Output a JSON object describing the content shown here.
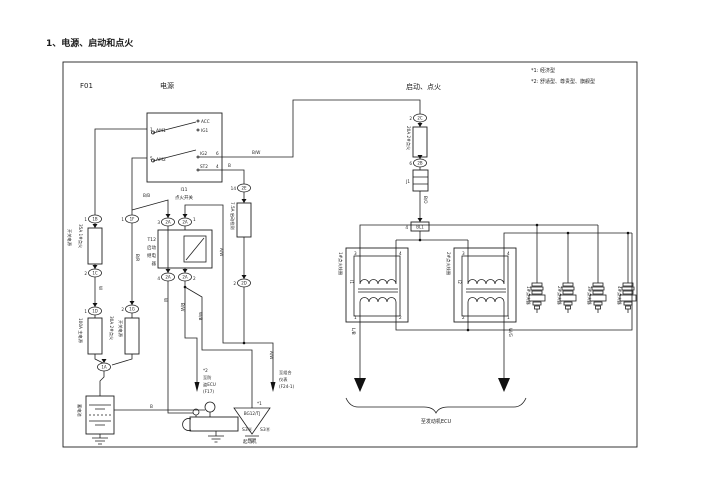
{
  "title": "1、电源、启动和点火",
  "header": {
    "code": "F01",
    "power": "电源",
    "start": "启动、点火",
    "note1": "*1: 经济型",
    "note2": "*2: 舒适型、尊贵型、旗舰型"
  },
  "switch": {
    "id": "I11",
    "name": "点火开关",
    "am1_pin": "1",
    "am1": "AM1",
    "am2_pin": "5",
    "am2": "AM2",
    "acc": "ACC",
    "ig1": "IG1",
    "ig2": "IG2",
    "ig2_pin": "6",
    "st2": "ST2",
    "st2_pin": "4"
  },
  "fuses": {
    "f1a": "开关电源",
    "f1b": "35A 1#点火",
    "f2": "100A 主电源",
    "f3a": "30A 2#点火",
    "f3b": "开关电源",
    "f4": "20A 2#点火",
    "f5": "7.5A 启动检测"
  },
  "relay": {
    "l1": "T12",
    "l2": "启动",
    "l3": "继电",
    "l4": "器",
    "pin_tl": "3",
    "pin_tr": "1",
    "pin_bl": "4",
    "pin_br": "2"
  },
  "battery": {
    "label": "蓄电池"
  },
  "starter": {
    "t1": "S3Ⓐ",
    "t2": "S3Ⓑ",
    "label": "起动机"
  },
  "connectors": {
    "o1_pin": "1",
    "o1": "1B",
    "o2_pin": "2",
    "o2": "1C",
    "o3_pin": "1",
    "o3": "1D",
    "o4": "1A",
    "o5_pin": "1",
    "o5": "1F",
    "o6_pin": "2",
    "o6": "1G",
    "o7": "2A",
    "o8": "2A",
    "o9": "2A",
    "o10": "2A",
    "o11_pin": "14",
    "o11": "2E",
    "o12_pin": "2",
    "o12": "2D",
    "o13_pin": "2",
    "o13": "2C",
    "o14_pin": "6",
    "o14": "2B",
    "jc": "J1",
    "bl1_pin": "4",
    "bl1": "BL1"
  },
  "wires": {
    "bw1": "B/W",
    "b1": "B",
    "bb": "B/B",
    "br": "B/R",
    "w1": "W",
    "w2": "W",
    "bw2": "B/W",
    "wb": "W/B",
    "aw1": "A/W",
    "aw2": "A/W",
    "b2": "B",
    "bo": "B/O",
    "lb": "L/B",
    "wg": "W/G"
  },
  "coils": {
    "c1_label": "1#点火线圈",
    "c1_id": "I1",
    "c2_label": "2#点火线圈",
    "c2_id": "I2",
    "p1": "1",
    "p2": "2",
    "p3": "3",
    "p4": "4"
  },
  "plugs": [
    "1#点火器",
    "2#点火器",
    "3#点火器",
    "4#点火器"
  ],
  "dest": {
    "engine_ecu": "至发动机ECU",
    "note2": "*2",
    "theft1": "至防",
    "theft2": "盗ECU",
    "theft3": "(F17)",
    "note1": "*1",
    "ground": "BG12/TJ",
    "cluster1": "至组合",
    "cluster2": "仪表",
    "cluster3": "(F24-1)"
  }
}
